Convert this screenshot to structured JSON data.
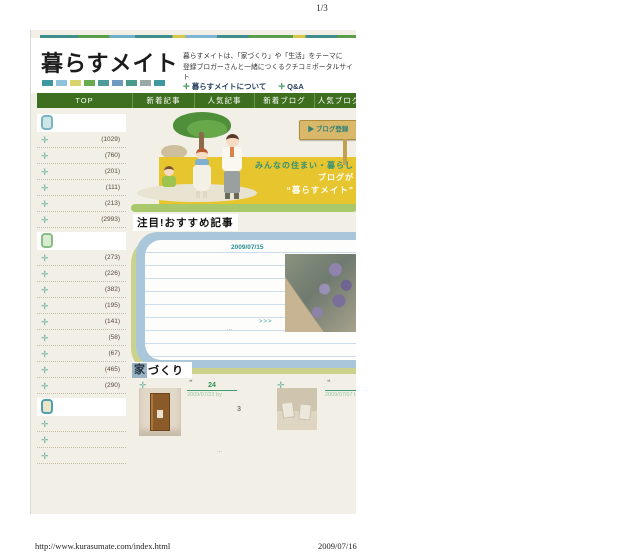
{
  "print": {
    "page_number": "1/3",
    "footer_url": "http://www.kurasumate.com/index.html",
    "footer_date": "2009/07/16"
  },
  "site": {
    "logo": "暮らすメイト",
    "tagline1": "暮らすメイトは、「家づくり」や「生活」をテーマに",
    "tagline2": "登録ブロガーさんと一緒につくるクチコミポータルサイト",
    "about_label": "暮らすメイトについて",
    "qa_label": "Q&A"
  },
  "icons": {
    "cross": "✛",
    "plus": "✛",
    "arrow": "▶",
    "quote": "❞"
  },
  "nav": {
    "items": [
      {
        "label": "TOP"
      },
      {
        "label": "新着記事"
      },
      {
        "label": "人気記事"
      },
      {
        "label": "新着ブログ"
      },
      {
        "label": "人気ブログ"
      }
    ]
  },
  "hero": {
    "sign_label": "▶ ブログ登録",
    "banner_line1": "みんなの住まい・暮らし",
    "banner_line2": "ブログが",
    "banner_line3": "“暮らすメイト”"
  },
  "sidebar": {
    "sections": [
      {
        "items": [
          {
            "count": "(1029)"
          },
          {
            "count": "(760)"
          },
          {
            "count": "(201)"
          },
          {
            "count": "(111)"
          },
          {
            "count": "(213)"
          },
          {
            "count": "(2993)"
          }
        ]
      },
      {
        "items": [
          {
            "count": "(273)"
          },
          {
            "count": "(226)"
          },
          {
            "count": "(382)"
          },
          {
            "count": "(195)"
          },
          {
            "count": "(141)"
          },
          {
            "count": "(58)"
          },
          {
            "count": "(67)"
          },
          {
            "count": "(465)"
          },
          {
            "count": "(290)"
          }
        ]
      },
      {
        "items": [
          {
            "count": ""
          },
          {
            "count": ""
          },
          {
            "count": ""
          }
        ]
      }
    ]
  },
  "featured": {
    "title": "注目!おすすめ記事",
    "date": "2009/07/15",
    "ellipsis": "...",
    "more": ">>>"
  },
  "category": {
    "title_first": "家",
    "title_rest": "づくり",
    "entries": [
      {
        "count": "24",
        "meta": "2009/07/22 by",
        "comments": "3"
      },
      {
        "count": "",
        "meta": "2009/07/07 by B",
        "comments": ""
      }
    ],
    "ellipsis": "..."
  },
  "colors": {
    "nav_green": "#3d6f1f",
    "banner_yellow": "#e6c52f",
    "teal_accent": "#2a8f8f",
    "olive_frame": "#ccd28c",
    "blue_frame": "#a9c6da"
  }
}
